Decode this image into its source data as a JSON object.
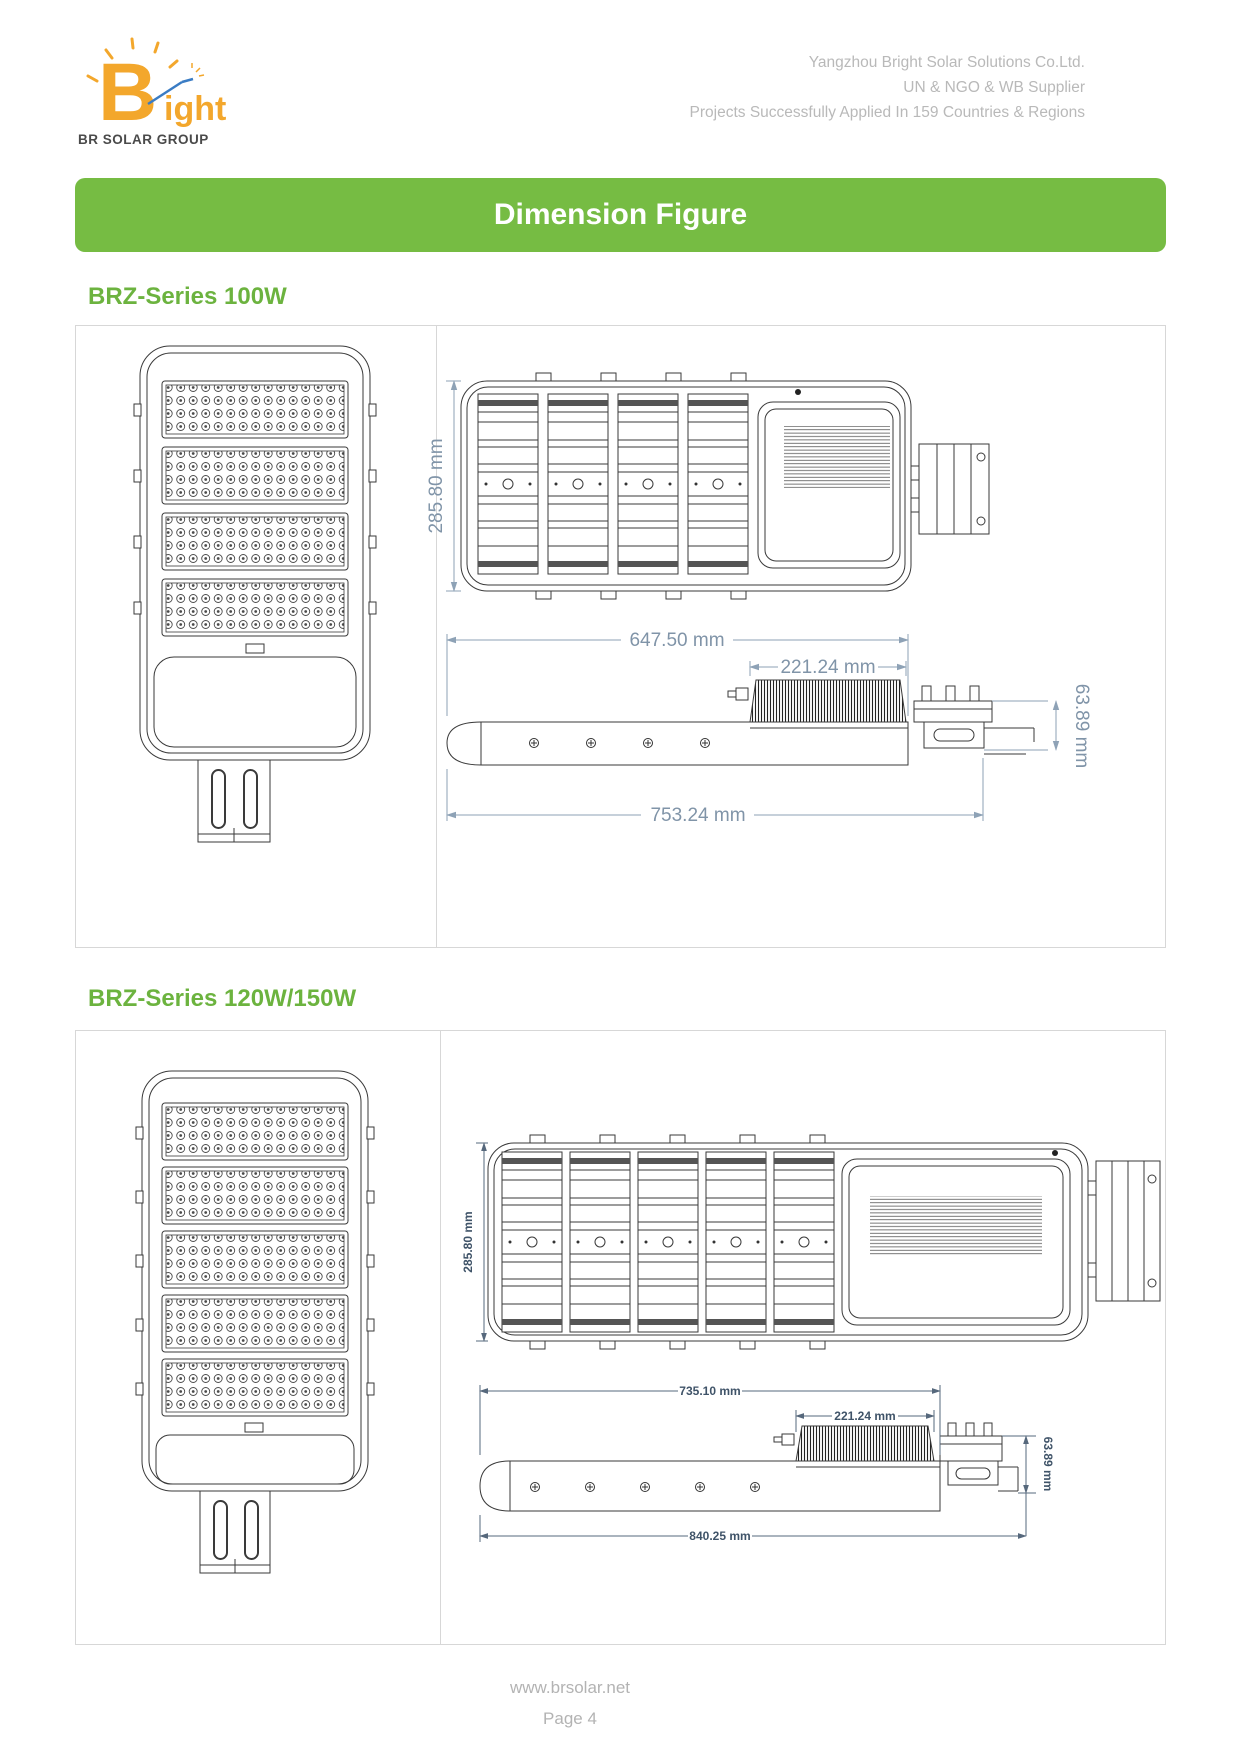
{
  "header": {
    "logo": {
      "letter_b": "B",
      "letters_rest": "ight",
      "subtitle": "BR SOLAR GROUP"
    },
    "company_lines": [
      "Yangzhou Bright Solar Solutions Co.Ltd.",
      "UN & NGO & WB Supplier",
      "Projects Successfully Applied In 159 Countries & Regions"
    ]
  },
  "banner": {
    "title": "Dimension Figure"
  },
  "sections": [
    {
      "heading": "BRZ-Series 100W",
      "figure": {
        "top_view_height": "285.80 mm",
        "side_body_length": "647.50 mm",
        "heatsink_length": "221.24 mm",
        "overall_length": "753.24 mm",
        "bracket_height": "63.89 mm",
        "led_module_count": 4
      }
    },
    {
      "heading": "BRZ-Series 120W/150W",
      "figure": {
        "top_view_height": "285.80 mm",
        "side_body_length": "735.10 mm",
        "heatsink_length": "221.24 mm",
        "overall_length": "840.25 mm",
        "bracket_height": "63.89 mm",
        "led_module_count": 5
      }
    }
  ],
  "footer": {
    "website": "www.brsolar.net",
    "page_label": "Page 4"
  },
  "colors": {
    "banner_green": "#76bc43",
    "heading_green": "#6cb33f",
    "dim_light": "#8094a8",
    "dim_dark": "#3f5368",
    "company_text": "#b9b9b9",
    "logo_orange": "#f3a72c"
  }
}
